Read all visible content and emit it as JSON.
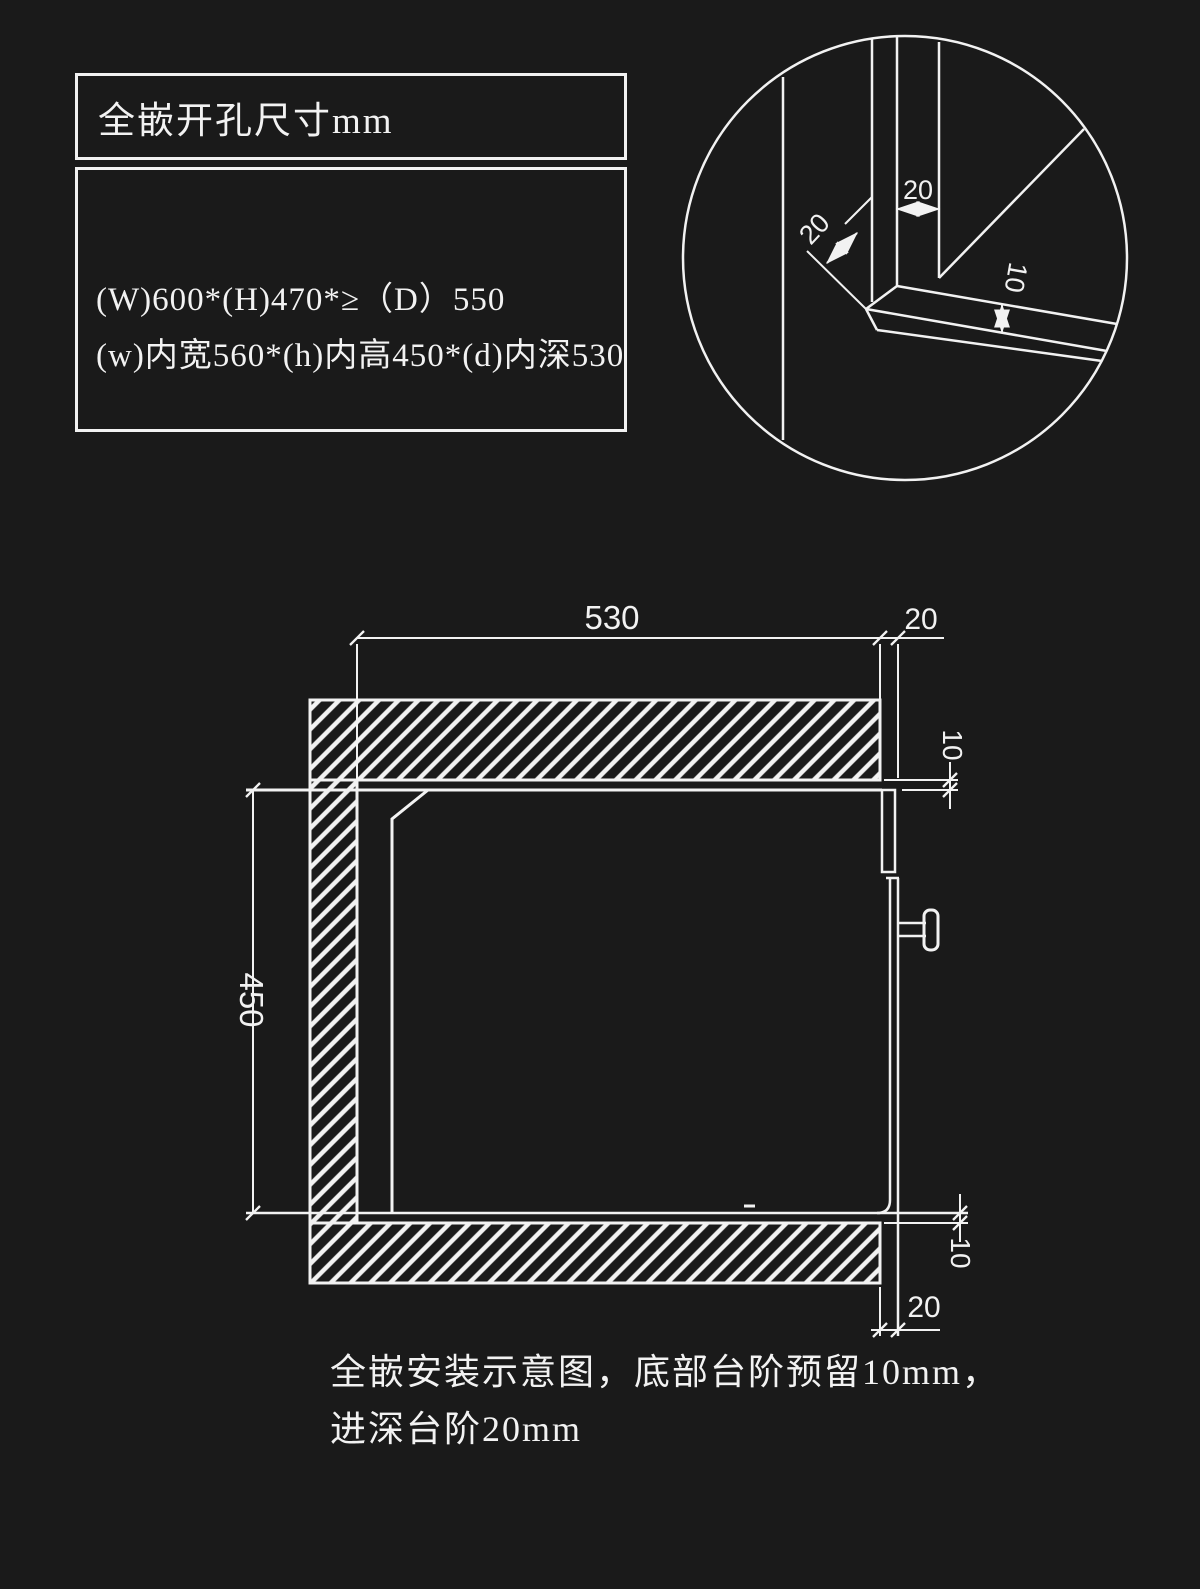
{
  "colors": {
    "background": "#1a1a1a",
    "line": "#f2f2f2"
  },
  "spec_box": {
    "title": "全嵌开孔尺寸mm",
    "line1": "(W)600*(H)470*≥（D）550",
    "line2": "(w)内宽560*(h)内高450*(d)内深530"
  },
  "detail_view": {
    "dim_front_step": "20",
    "dim_chamfer": "20",
    "dim_panel_thickness": "10"
  },
  "main_view": {
    "dim_inner_depth": "530",
    "dim_depth_step": "20",
    "dim_top_gap": "10",
    "dim_inner_height": "450",
    "dim_bottom_gap": "10",
    "dim_bottom_step": "20"
  },
  "caption": {
    "line1": "全嵌安装示意图，底部台阶预留10mm，",
    "line2": "进深台阶20mm"
  }
}
